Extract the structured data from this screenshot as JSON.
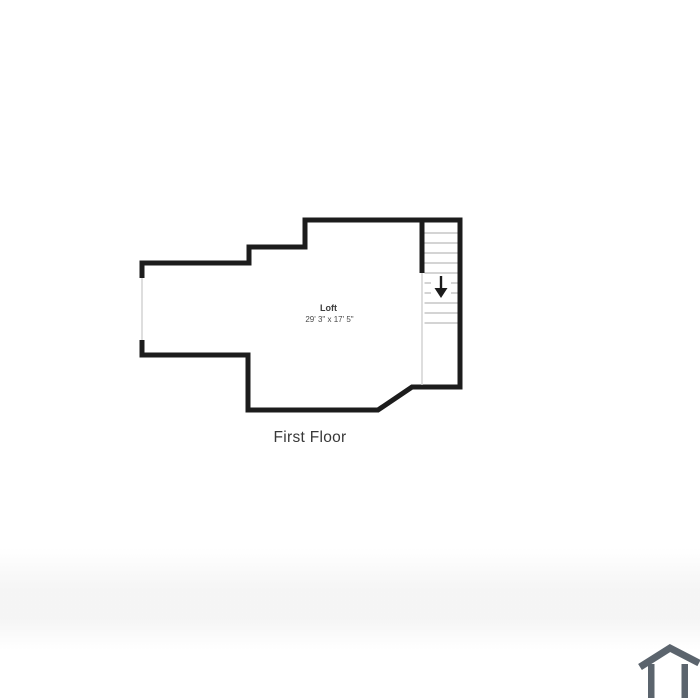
{
  "plan": {
    "room": {
      "name": "Loft",
      "dimensions": "29' 3\" x 17' 5\""
    },
    "floor_label": "First Floor"
  },
  "stairs": {
    "direction": "down",
    "tread_x1": 424.5,
    "tread_x2": 457.5,
    "treads_y": [
      233,
      243,
      253,
      263,
      273,
      283,
      293,
      303,
      313,
      323
    ]
  },
  "colors": {
    "background": "#ffffff",
    "wall": "#1c1c1c",
    "tread": "#c6c6c6",
    "window_line": "#cfcfcf",
    "label": "#3d3d3d",
    "dims": "#4a4a4a",
    "floor_label": "#383838",
    "icon": "#5b646d"
  }
}
